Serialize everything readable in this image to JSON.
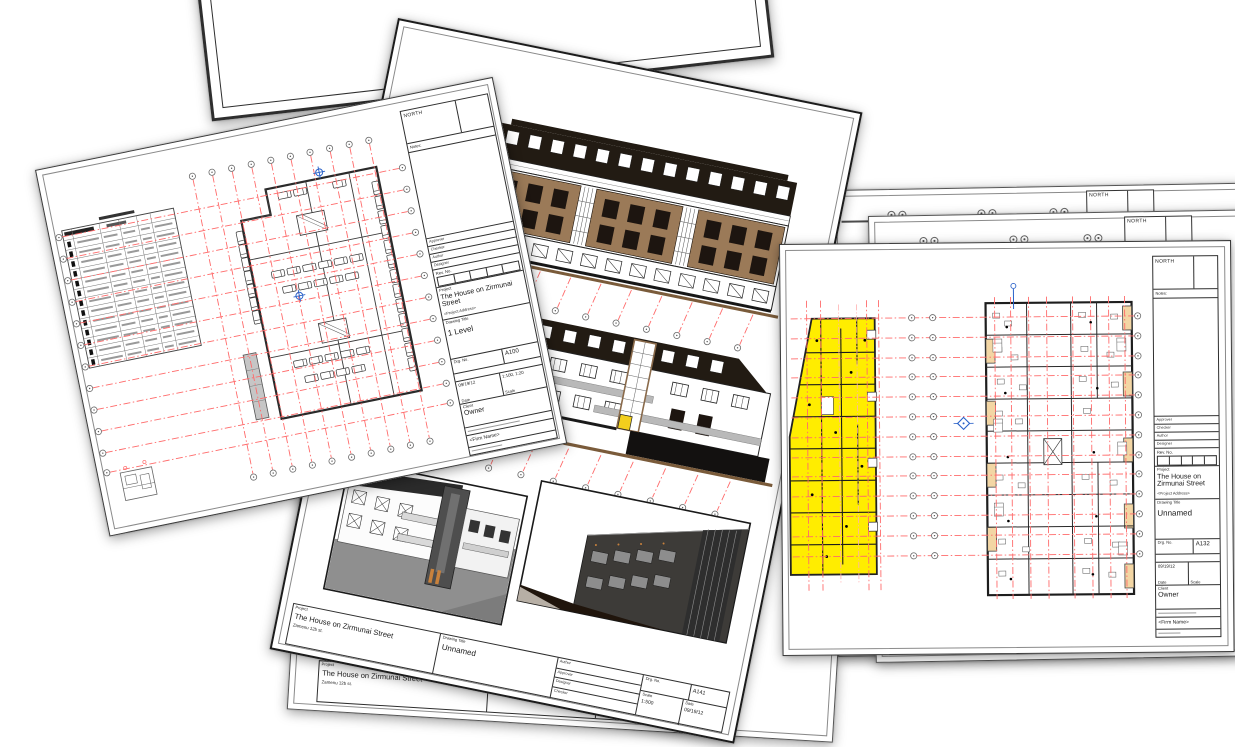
{
  "colors": {
    "grid_red": "#ff6b6b",
    "grid_red_light": "#ffb0b0",
    "highlight_yellow": "#ffed00",
    "facade_brown": "#9b7a58",
    "facade_dark": "#221b13",
    "balcony_tan": "#f3d6a4",
    "marker_blue": "#2b62c9",
    "ramp_gray": "#c6c6c6",
    "ground_brown": "#7a5b3a"
  },
  "labels": {
    "north": "NORTH",
    "notes": "Notes:",
    "rev_no": "Rev. No.",
    "project": "Project",
    "drawing_title": "Drawing Title",
    "drg_no": "Drg. No.",
    "date": "Date",
    "scale": "Scale",
    "client": "Client",
    "author": "Author",
    "approver": "Approver",
    "designer": "Designer",
    "checker": "Checker",
    "firm_name": "<Firm Name>",
    "project_address_placeholder": "<Project Address>"
  },
  "sheet_parking": {
    "project_name": "The House on Zirmunai Street",
    "drawing_title": "1 Level",
    "drg_no": "A100",
    "date": "09/19/12",
    "scale": "1:100, 1:20",
    "client": "Owner"
  },
  "sheet_elevations": {
    "project_name": "The House on Zirmunai Street",
    "project_address": "Zamenu 12b st.",
    "drawing_title": "Unnamed",
    "drg_no": "A141",
    "scale": "1:500",
    "date": "09/19/12"
  },
  "sheet_floorplan": {
    "project_name": "The House on Zirmunai Street",
    "drawing_title": "Unnamed",
    "drg_no": "A132",
    "date": "09/19/12",
    "client": "Owner"
  },
  "sheet_behind": {
    "project_name": "The House on Zirmunai Street",
    "project_address": "Zamenu 12b st."
  }
}
